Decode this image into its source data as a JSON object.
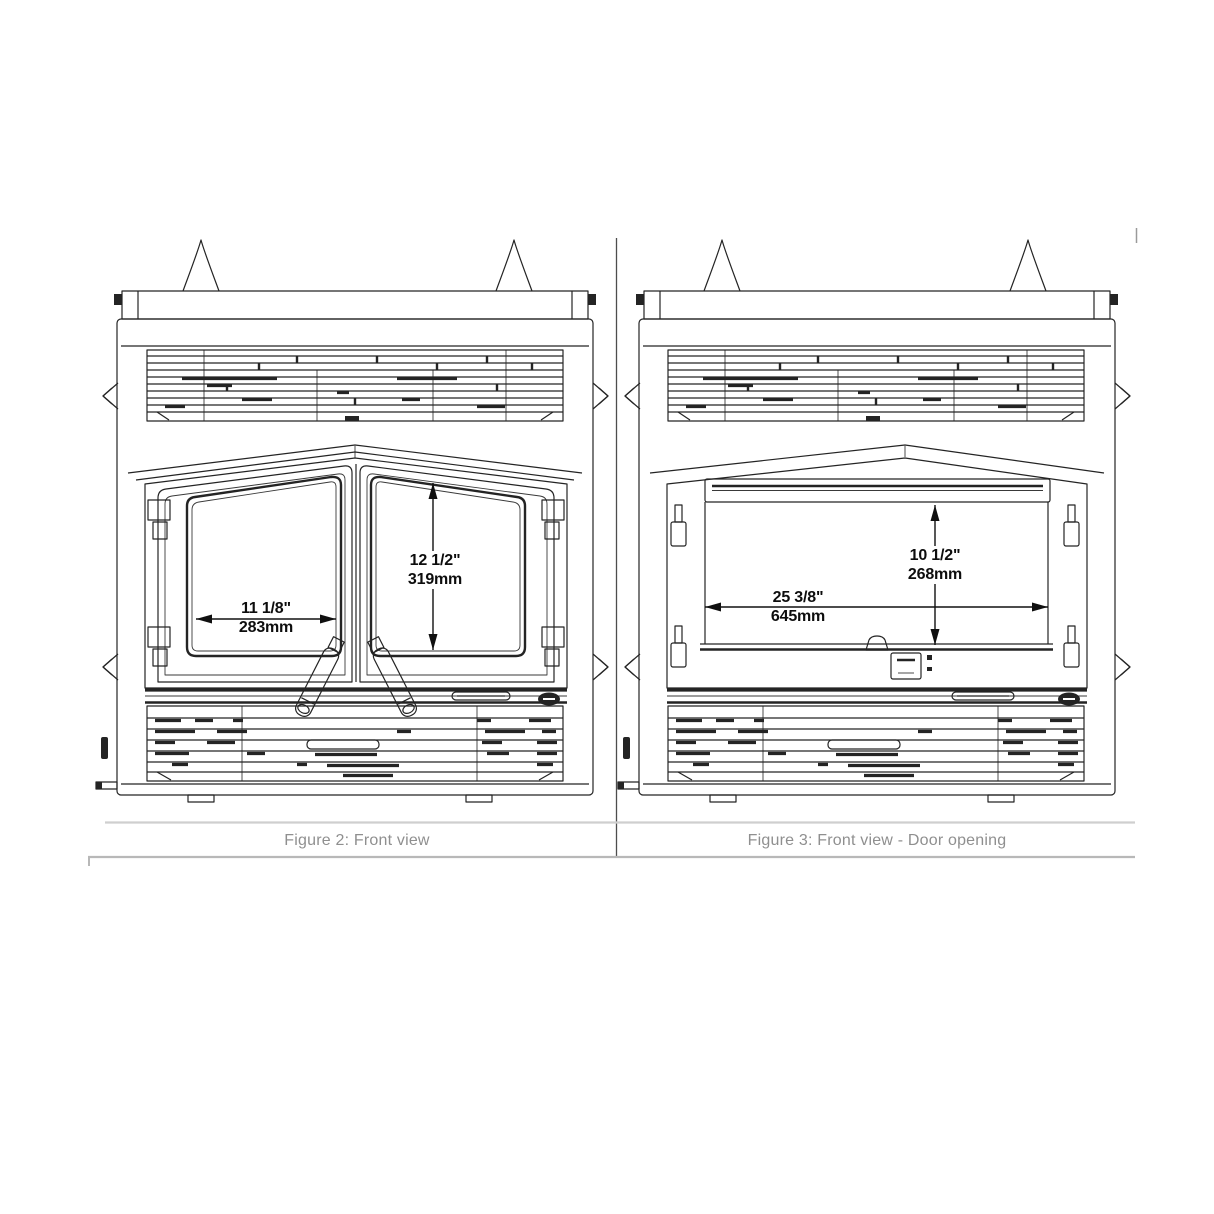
{
  "document": {
    "type": "fireplace installation manual figure panel",
    "background": "#ffffff"
  },
  "figures": [
    {
      "caption": "Figure 2: Front view",
      "dimensions": {
        "width": {
          "inches": "11 1/8\"",
          "mm": "283mm"
        },
        "height": {
          "inches": "12 1/2\"",
          "mm": "319mm"
        }
      }
    },
    {
      "caption": "Figure 3: Front view - Door opening",
      "dimensions": {
        "width": {
          "inches": "25 3/8\"",
          "mm": "645mm"
        },
        "height": {
          "inches": "10 1/2\"",
          "mm": "268mm"
        }
      }
    }
  ],
  "colors": {
    "line": "#242424",
    "dimension_text": "#0d0d0d",
    "caption_text": "#8f8f8f",
    "rule_light": "#cfcfcf",
    "rule_mid": "#b8b8b8",
    "divider": "#4d4d4d",
    "background": "#ffffff"
  }
}
